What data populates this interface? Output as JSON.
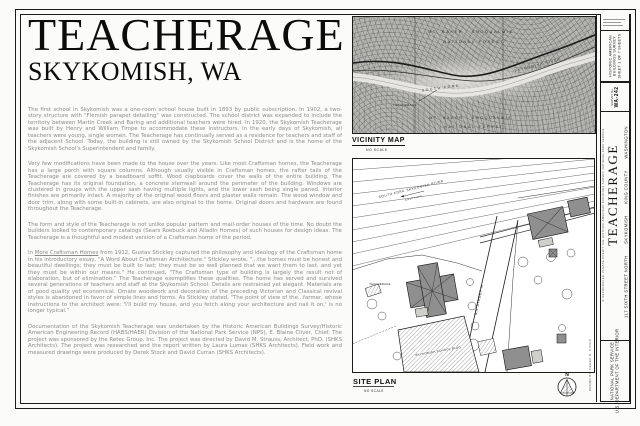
{
  "title": {
    "name": "TEACHERAGE",
    "location": "SKYKOMISH, WA"
  },
  "body": {
    "p1": "The first school in Skykomish was a one-room school house built in 1893 by public subscription.  In 1902, a two-story structure with \"Flemish parapet detailing\" was constructed.  The school district was expanded to include the territory between Martin Creek and Baring and additional teachers were hired.  In 1920, the Skykomish Teacherage was built by Henry and William Timpe to accommodate these instructors.  In the early days of Skykomish, all teachers were young, single women.  The Teacherage has continually served as a residence for teachers and staff of the adjacent School.  Today, the building is still owned by the Skykomish School District and is the home of the Skykomish School's Superintendent and family.",
    "p2": "Very few modifications have been made to the house over the years.  Like most Craftsman homes, the Teacherage has a large porch with square columns.  Although usually visible in Craftsman homes, the rafter tails of the Teacherage are covered by a beadboard soffit.  Wood clapboards cover the walls of the entire building.  The Teacherage has its original foundation, a concrete stemwall around the perimeter of the building.  Windows are clustered in groups with the upper sash having multiple lights, and the lower sash being single paned.  Interior finishes are primarily intact.  A majority of the original wood floors and plaster walls remain.  The wood window and door trim, along with some built-in cabinets, are also original to the home.  Original doors and hardware are found throughout the Teacherage.",
    "p3": "The form and style of the Teacherage is not unlike popular pattern and mail-order houses of the time.  No doubt the builders looked to contemporary catalogs (Sears Roebuck and Alladin Homes) of such houses for design ideas.  The Teacherage is a thoughtful and modest version of a Craftsman home of the period.",
    "p4_pre": "In ",
    "p4_underlined": "More Craftsman Homes",
    "p4_rest": " from 1912, Gustav Stickley captured the philosophy and ideology of the Craftsman home in his introductory essay, \"A Word About Craftsman Architecture.\"  Stickley wrote, \"...the homes must be honest and beautiful dwellings;  they must be built to last;  they must be so well planned that we want them to last, and yet they must be within our means.\"  He continued, \"The Craftsman type of building is largely the result not of elaboration, but of elimination.\"  The Teacherage exemplifies these qualities.  The home has served and survived several generations of teachers and staff at the Skykomish School.  Details are restrained yet elegant.  Materials are of good quality yet economical.  Ornate woodwork and decoration of the preceding Victorian and Classical revival styles is abandoned in favor of simple lines and forms.  As Stickley stated, \"The point of view of the...farmer, whose instructions to the architect were: 'I'll build my house, and you fetch along your architecture and nail it on,' is no longer typical.\"",
    "p5": "Documentation of the Skykomish Teacherage was undertaken by the Historic American Buildings Survey/Historic American Engineering Record (HABS/HAER) Division of the National Park Service (NPS), E. Blaine Cliver, Chief.  The project was sponsored by the Retec Group, Inc.  The project was directed by David M. Strauss, Architect, PhD. (SHKS Architects).  The project was researched and the report written by Laura Lumas (SHKS Architects).  Field work and measured drawings were produced by Derek Stock and David Curran (SHKS Architects)."
  },
  "vicinity_map": {
    "label": "VICINITY MAP",
    "scale": "NO SCALE",
    "forest_top_1": "MT. BAKER - SNOQUALMIE",
    "forest_top_2": "NATIONAL FOREST",
    "river_1": "SOUTH FORK",
    "river_2": "SKYKOMISH RIVER",
    "site_callout": "TEACHERAGE",
    "forest_bottom_1": "MT. BAKER - SNOQUALMIE",
    "forest_bottom_2": "NATIONAL FOREST"
  },
  "site_plan": {
    "label": "SITE PLAN",
    "scale": "NO SCALE",
    "north_letter": "N",
    "river_label": "SOUTH FORK SKYKOMISH RIVER",
    "river_flow": "RIVER FLOW",
    "road_label": "RIVER VIEW RD",
    "street_label": "6th STREET N",
    "teacherage_label": "TEACHERAGE",
    "school_label": "SKYKOMISH SCHOOL BLDG."
  },
  "title_block": {
    "survey_line1": "HISTORIC AMERICAN",
    "survey_line2": "BUILDINGS SURVEY",
    "sheet_line": "SHEET 1 OF 7 SHEETS",
    "survey_no_label": "SURVEY No.",
    "survey_no": "WA-242",
    "name": "TEACHERAGE",
    "address": "117 SIXTH STREET NORTH",
    "city": "SKYKOMISH",
    "county": "KING COUNTY",
    "state": "WASHINGTON",
    "credit": "IF REPRODUCED, PLEASE CREDIT THE HISTORIC AMERICAN BUILDINGS SURVEY, NATIONAL PARK SERVICE",
    "agency_line1": "NATIONAL PARK SERVICE",
    "agency_line2": "U.S. DEPARTMENT OF THE INTERIOR",
    "drawn_by": "DRAWN BY: DEREK R. STOCK"
  }
}
